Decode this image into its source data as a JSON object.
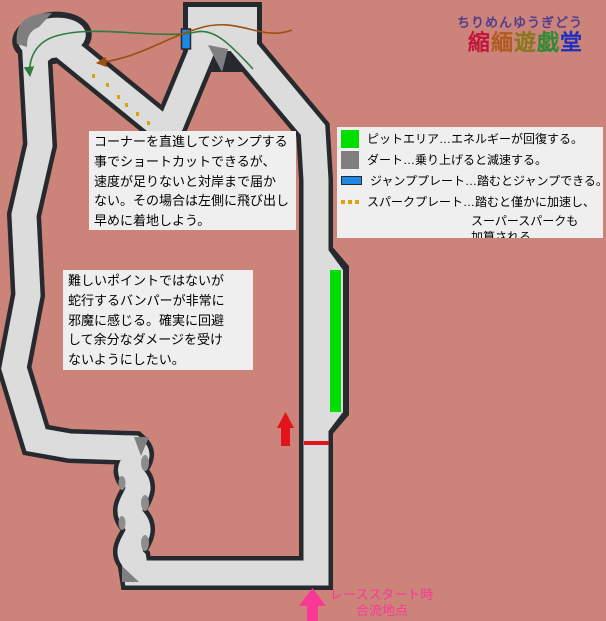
{
  "logo": {
    "furigana": "ちりめんゆうぎどう",
    "title_chars": [
      {
        "ch": "縮",
        "style": "color:#c2143c"
      },
      {
        "ch": "緬",
        "style": "color:#b05a1e"
      },
      {
        "ch": "遊",
        "style": "color:#85781b"
      },
      {
        "ch": "戯",
        "style": "color:#2f8a33"
      },
      {
        "ch": "堂",
        "style": "color:#1d2fc0"
      }
    ]
  },
  "legend": {
    "items": [
      {
        "icon": "pit-area-swatch",
        "label": "ピットエリア…エネルギーが回復する。"
      },
      {
        "icon": "dirt-swatch",
        "label": "ダート…乗り上げると減速する。"
      },
      {
        "icon": "jump-plate-swatch",
        "label": "ジャンププレート…踏むとジャンプできる。"
      },
      {
        "icon": "spark-plate-swatch",
        "label": "スパークプレート…踏むと僅かに加速し、"
      }
    ],
    "continuation_lines": [
      "スーパースパークも",
      "加算される。"
    ]
  },
  "notes": {
    "note1": {
      "lines": [
        "コーナーを直進してジャンプする",
        "事でショートカットできるが、",
        "速度が足りないと対岸まで届か",
        "ない。その場合は左側に飛び出し",
        "早めに着地しよう。"
      ]
    },
    "note2": {
      "lines": [
        "難しいポイントではないが",
        "蛇行するバンパーが非常に",
        "邪魔に感じる。確実に回避",
        "して余分なダメージを受け",
        "ないようにしたい。"
      ]
    }
  },
  "start_label": {
    "line1": "レーススタート時",
    "line2": "合流地点"
  },
  "colors": {
    "background": "#cc8379",
    "track_surface": "#dcdcdc",
    "track_outline": "#26292d",
    "dirt": "#7f7f7f",
    "pit_area_green": "#00df00",
    "jump_plate_blue": "#1e88e5",
    "spark_plate_gold": "#d9a40e",
    "start_line_red": "#e2131b",
    "direction_arrow_red": "#e2131b",
    "merge_arrow_pink": "#fb3898",
    "jump_success_arrow_green": "#2e7d3e",
    "jump_fail_arrow_brown": "#9c4f10"
  }
}
